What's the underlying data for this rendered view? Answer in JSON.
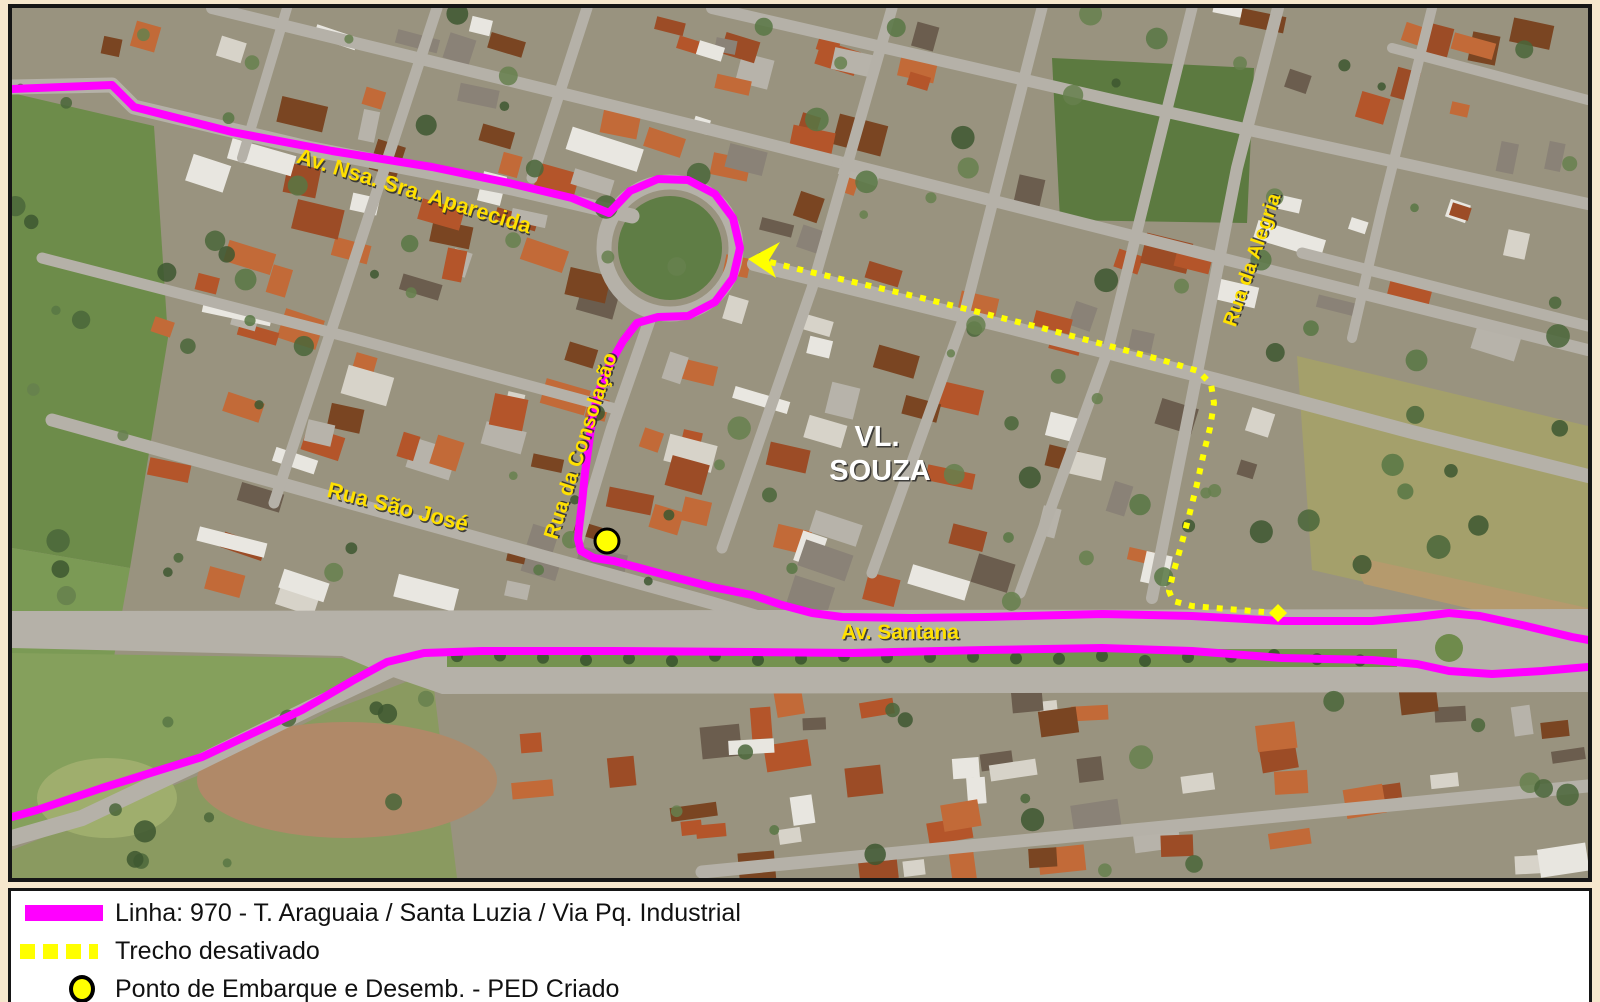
{
  "map": {
    "district_label": {
      "line1": "VL.",
      "line2": "SOUZA"
    },
    "district_color": "#ffffff",
    "label_color": "#ffe000",
    "street_labels": [
      {
        "id": "av-nsa-sra-aparecida",
        "text": "Av. Nsa. Sra. Aparecida",
        "x": 400,
        "y": 190,
        "rotate": 17,
        "size": 22
      },
      {
        "id": "rua-da-consolacao",
        "text": "Rua da Consolação",
        "x": 575,
        "y": 440,
        "rotate": -72,
        "size": 21
      },
      {
        "id": "rua-sao-jose",
        "text": "Rua São José",
        "x": 384,
        "y": 506,
        "rotate": 14,
        "size": 22
      },
      {
        "id": "av-santana",
        "text": "Av. Santana",
        "x": 888,
        "y": 631,
        "rotate": 0,
        "size": 21
      },
      {
        "id": "rua-da-alegria",
        "text": "Rua da Alegria",
        "x": 1246,
        "y": 254,
        "rotate": -71,
        "size": 20
      }
    ],
    "route_line": {
      "name": "Linha 970",
      "color": "#ff00ff",
      "width": 8,
      "path_north": [
        [
          0,
          81
        ],
        [
          100,
          77
        ],
        [
          122,
          99
        ],
        [
          220,
          124
        ],
        [
          320,
          143
        ],
        [
          420,
          159
        ],
        [
          497,
          175
        ],
        [
          560,
          190
        ],
        [
          597,
          205
        ],
        [
          618,
          183
        ],
        [
          646,
          171
        ],
        [
          676,
          172
        ],
        [
          703,
          186
        ],
        [
          721,
          210
        ],
        [
          728,
          240
        ],
        [
          721,
          270
        ],
        [
          703,
          294
        ],
        [
          676,
          308
        ],
        [
          646,
          309
        ],
        [
          625,
          315
        ],
        [
          611,
          333
        ],
        [
          598,
          356
        ],
        [
          588,
          380
        ],
        [
          581,
          405
        ],
        [
          577,
          435
        ],
        [
          573,
          465
        ],
        [
          570,
          495
        ],
        [
          567,
          520
        ],
        [
          566,
          531
        ],
        [
          569,
          543
        ],
        [
          582,
          550
        ],
        [
          602,
          553
        ],
        [
          650,
          566
        ],
        [
          700,
          579
        ],
        [
          740,
          587
        ],
        [
          770,
          597
        ],
        [
          800,
          605
        ],
        [
          830,
          609
        ],
        [
          900,
          610
        ],
        [
          973,
          609
        ],
        [
          1090,
          606
        ],
        [
          1180,
          608
        ],
        [
          1270,
          613
        ],
        [
          1360,
          613
        ],
        [
          1405,
          609
        ],
        [
          1437,
          605
        ],
        [
          1468,
          608
        ],
        [
          1510,
          617
        ],
        [
          1560,
          629
        ],
        [
          1576,
          632
        ]
      ],
      "path_south": [
        [
          0,
          809
        ],
        [
          25,
          802
        ],
        [
          90,
          780
        ],
        [
          190,
          749
        ],
        [
          290,
          702
        ],
        [
          340,
          673
        ],
        [
          375,
          654
        ],
        [
          412,
          645
        ],
        [
          470,
          643
        ],
        [
          600,
          643
        ],
        [
          740,
          644
        ],
        [
          840,
          645
        ],
        [
          973,
          642
        ],
        [
          1090,
          640
        ],
        [
          1180,
          643
        ],
        [
          1270,
          650
        ],
        [
          1360,
          652
        ],
        [
          1405,
          656
        ],
        [
          1437,
          663
        ],
        [
          1480,
          666
        ],
        [
          1530,
          663
        ],
        [
          1576,
          659
        ]
      ]
    },
    "inactive_stretch": {
      "color": "#ffff00",
      "width": 6,
      "points": [
        [
          758,
          254
        ],
        [
          790,
          262
        ],
        [
          850,
          276
        ],
        [
          910,
          290
        ],
        [
          970,
          305
        ],
        [
          1030,
          320
        ],
        [
          1090,
          336
        ],
        [
          1150,
          352
        ],
        [
          1186,
          363
        ],
        [
          1199,
          376
        ],
        [
          1202,
          395
        ],
        [
          1198,
          420
        ],
        [
          1192,
          444
        ],
        [
          1185,
          476
        ],
        [
          1177,
          508
        ],
        [
          1169,
          538
        ],
        [
          1161,
          566
        ],
        [
          1157,
          583
        ],
        [
          1161,
          593
        ],
        [
          1180,
          598
        ],
        [
          1215,
          601
        ],
        [
          1252,
          604
        ]
      ],
      "arrow_head": [
        [
          736,
          251
        ],
        [
          768,
          234
        ],
        [
          757,
          252
        ],
        [
          764,
          270
        ]
      ],
      "end_diamond": [
        1266,
        605
      ]
    },
    "ped_point": {
      "x": 595,
      "y": 533,
      "radius": 12,
      "fill": "#ffff00",
      "stroke": "#000000"
    }
  },
  "legend": {
    "items": [
      {
        "type": "line",
        "color": "#ff00ff",
        "label": "Linha: 970 - T. Araguaia / Santa Luzia / Via Pq. Industrial"
      },
      {
        "type": "dashed",
        "color": "#ffff00",
        "label": "Trecho desativado"
      },
      {
        "type": "point",
        "color": "#ffff00",
        "label": "Ponto de Embarque e Desemb. - PED Criado"
      }
    ]
  },
  "colors": {
    "canvas_bg": "#f6e7cd",
    "map_border": "#161616",
    "legend_bg": "#ffffff",
    "road": "#b5b1a8",
    "field_green": "#6d8c4a"
  }
}
